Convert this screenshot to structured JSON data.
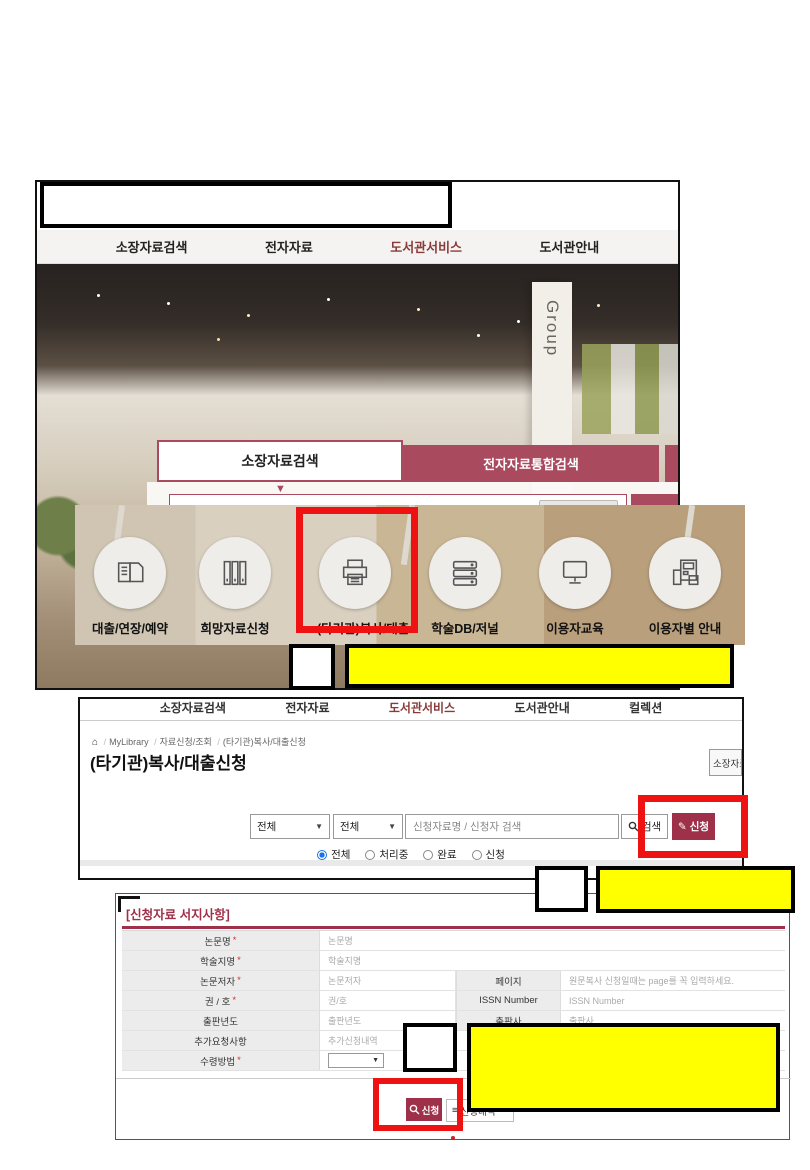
{
  "accent": {
    "maroon_tab": "#a94a5e",
    "maroon_button": "#9e3049",
    "nav_red_text": "#8b3a3a",
    "highlight_red": "#ee1212",
    "highlight_yellow": "#ffff00",
    "radio_blue": "#1a73e8"
  },
  "s1": {
    "nav": [
      "소장자료검색",
      "전자자료",
      "도서관서비스",
      "도서관안내"
    ],
    "pillar_text_top": "Group",
    "pillar_text_bottom": "one",
    "tabs": {
      "active": "소장자료검색",
      "inactive": "전자자료통합검색"
    },
    "search": {
      "placeholder": "검색어를 입력하세요.",
      "autocomplete_off": "자동완성끄기",
      "button": "검색"
    },
    "quick_menu": [
      "대출/연장/예약",
      "희망자료신청",
      "(타기관)복사/대출",
      "학술DB/저널",
      "이용자교육",
      "이용자별 안내"
    ],
    "dim_labels": [
      "대출/연장/예약",
      "희망자료신청"
    ]
  },
  "s2": {
    "nav": [
      "소장자료검색",
      "전자자료",
      "도서관서비스",
      "도서관안내",
      "컬렉션"
    ],
    "breadcrumb": {
      "home": "⌂",
      "item1": "MyLibrary",
      "item2": "자료신청/조회",
      "item3": "(타기관)복사/대출신청"
    },
    "title": "(타기관)복사/대출신청",
    "side_button": "소장자료",
    "filter": {
      "select1": "전체",
      "select2": "전체",
      "search_placeholder": "신청자료명 / 신청자 검색",
      "search_button": "검색",
      "apply_button": "신청",
      "radio1": "전체",
      "radio2": "처리중",
      "radio3": "완료",
      "radio4": "신청"
    }
  },
  "s3": {
    "section_title": "[신청자료 서지사항]",
    "required_mark": "*",
    "rows": [
      {
        "label": "논문명",
        "placeholder": "논문명"
      },
      {
        "label": "학술지명",
        "placeholder": "학술지명"
      },
      {
        "label": "논문저자",
        "placeholder": "논문저자",
        "label2": "페이지",
        "placeholder2": "원문복사 신청일때는 page를 꼭 입력하세요."
      },
      {
        "label": "권 / 호",
        "placeholder": "권/호",
        "label2": "ISSN Number",
        "placeholder2": "ISSN Number"
      },
      {
        "label": "출판년도",
        "placeholder": "출판년도",
        "label2": "출판사",
        "placeholder2": "출판사"
      },
      {
        "label": "추가요청사항",
        "placeholder": "추가신청내역"
      },
      {
        "label": "수령방법"
      }
    ],
    "submit_button": "신청",
    "list_button": "신청내역"
  }
}
